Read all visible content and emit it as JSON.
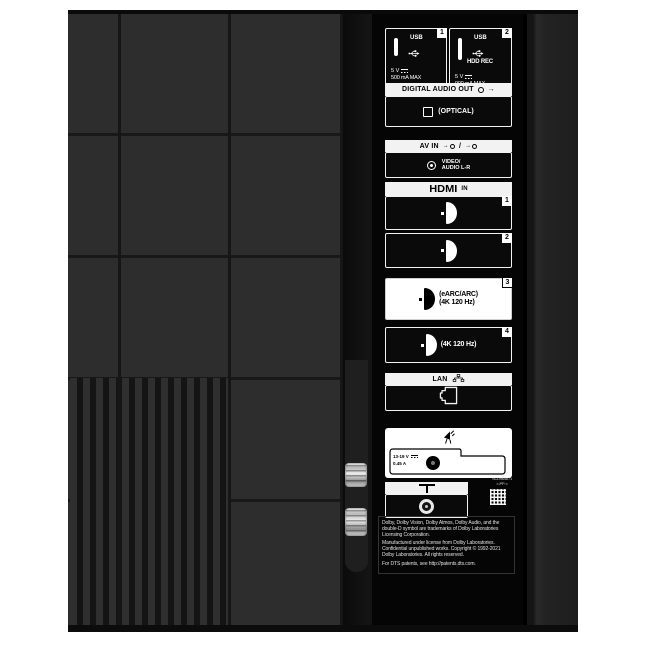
{
  "panel": {
    "usb1": {
      "badge": "1",
      "label": "USB",
      "voltage": "5 V",
      "max": "500 mA MAX"
    },
    "usb2": {
      "badge": "2",
      "label": "USB",
      "hdd": "HDD REC",
      "voltage": "5 V",
      "max": "900 mA MAX"
    },
    "digital_audio_out": {
      "title": "DIGITAL AUDIO OUT",
      "optical": "(OPTICAL)"
    },
    "av_in": {
      "title": "AV IN",
      "separator": "/",
      "video": "VIDEO/",
      "audio": "AUDIO L-R"
    },
    "hdmi": {
      "logo": "HDMI",
      "in": "IN",
      "port1": {
        "badge": "1"
      },
      "port2": {
        "badge": "2"
      },
      "port3": {
        "badge": "3",
        "line1": "(eARC/ARC)",
        "line2": "(4K 120 Hz)"
      },
      "port4": {
        "badge": "4",
        "line1": "(4K 120 Hz)"
      }
    },
    "lan": {
      "title": "LAN"
    },
    "satellite": {
      "voltage": "13-19 V",
      "current": "0.45 A"
    },
    "serial": {
      "line1": "SCD964671",
      "line2": ">-PP-<"
    },
    "legal": {
      "line1": "Dolby, Dolby Vision, Dolby Atmos, Dolby Audio, and the",
      "line2": "double-D symbol are trademarks of Dolby Laboratories",
      "line3": "Licensing Corporation.",
      "line4": "Manufactured under license from Dolby Laboratories.",
      "line5": "Confidential unpublished works. Copyright © 1992-2021",
      "line6": "Dolby Laboratories. All rights reserved.",
      "dts": "For DTS patents, see http://patents.dts.com."
    }
  },
  "colors": {
    "background": "#ffffff",
    "back_panel": "#2d2d2d",
    "connector_panel": "#050505",
    "label_light": "#f2f2f2",
    "highlight_box": "#ffffff"
  }
}
